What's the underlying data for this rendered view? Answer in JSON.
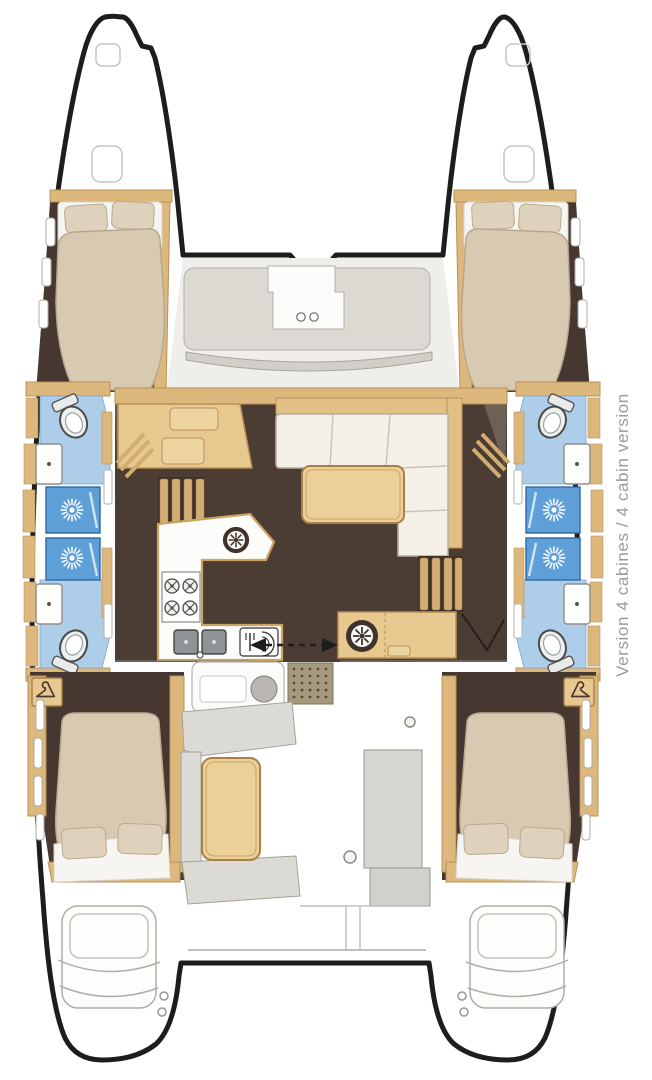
{
  "figure": {
    "caption": "Version 4 cabines / 4 cabin version",
    "type": "catamaran 4-cabin floor plan"
  },
  "colors": {
    "hull_outline": "#1d1d1b",
    "floor_brown": "#4b3c34",
    "cabin_floor": "#463830",
    "wood": "#e7c88f",
    "wood_dark": "#dcb87c",
    "wood_trim": "#b8905a",
    "bathroom_blue": "#aecde9",
    "shower_blue": "#5f9fd8",
    "bed_beige": "#d8c9b1",
    "pillow_beige": "#ded2bc",
    "deck_gray": "#dcdad4",
    "caption_gray": "#9b9b9b"
  },
  "icons": [
    "shower-jet-icon",
    "toilet-icon",
    "washbasin-icon",
    "stove-burners-icon",
    "double-sink-icon",
    "dishwasher-icon",
    "round-vent-icon",
    "hanger-icon",
    "deck-hatch-icon",
    "sliding-door-arrows-icon",
    "doormat-icon",
    "bow-hatch-icon"
  ]
}
